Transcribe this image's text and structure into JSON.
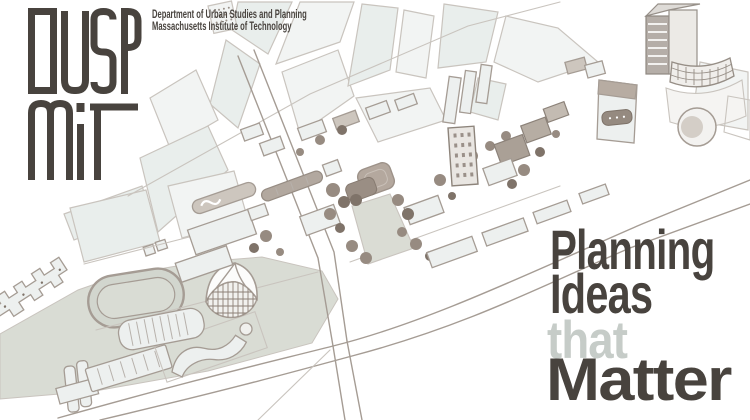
{
  "header": {
    "logo_text": "DUSP MIT",
    "logo_line1": "DUSP",
    "logo_line2": "MIT",
    "dept_line1": "Department of Urban Studies and Planning",
    "dept_line2": "Massachusetts Institute of Technology"
  },
  "tagline": {
    "line1": "Planning",
    "line2": "Ideas",
    "line3": "that",
    "line4": "Matter"
  },
  "map": {
    "alt": "Hand-drawn axonometric sketch of the MIT campus along the Charles River",
    "landmarks": [
      "city blocks",
      "west campus field",
      "athletic track",
      "Johnson Athletic Center",
      "Kresge Auditorium",
      "MIT Chapel",
      "west campus dormitories",
      "Baker House",
      "Massachusetts Avenue",
      "Memorial Drive",
      "main group buildings",
      "Great Dome",
      "Killian Court",
      "campus trees",
      "east campus buildings",
      "Media Lab cluster",
      "Kendall Square tower"
    ]
  },
  "colors": {
    "ink": "#48433e",
    "muted": "#c6ccc8",
    "stroke": "#a59c94",
    "sfaint": "#c9c4be",
    "parcel": "#f2f4f3",
    "parcelCool": "#e9eeec",
    "bfill": "#edf0ef",
    "btan": "#cdc6be",
    "bdark": "#aaa096",
    "tree": "#978b81",
    "tree2": "#7f7369",
    "dome": "#b4a89e",
    "field": "#d9dcd4",
    "track": "#d2d6ce",
    "court": "#dadcd4"
  }
}
